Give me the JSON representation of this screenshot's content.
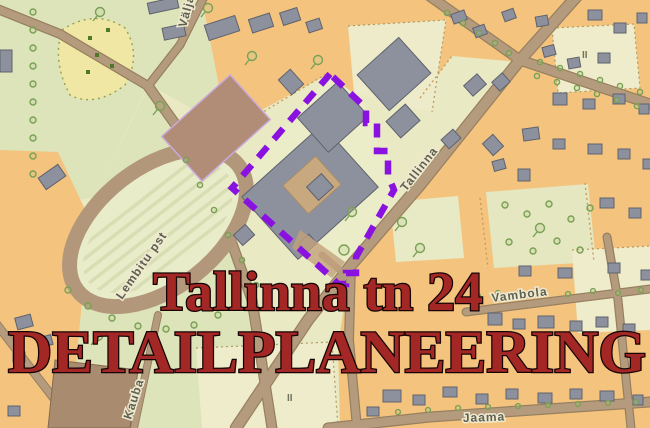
{
  "map": {
    "overlay": {
      "line1": "Tallinna tn 24",
      "line2": "DETAILPLANEERING",
      "text_color": "#a32725",
      "outline_color": "#150303"
    },
    "streets": [
      {
        "name": "Välja"
      },
      {
        "name": "Tallinna"
      },
      {
        "name": "Lembitu pst"
      },
      {
        "name": "Kauba"
      },
      {
        "name": "Vambola"
      },
      {
        "name": "Jaama"
      }
    ],
    "markers": [
      {
        "text": "II"
      },
      {
        "text": "II"
      }
    ],
    "boundary": {
      "color": "#8a12e0",
      "style": "dashed"
    },
    "colors": {
      "background": "#e9e9c4",
      "block_orange": "#f4c47f",
      "park_green": "#dde4ba",
      "field_yellow": "#efe7a3",
      "cream": "#eeecca",
      "road": "#b59b7d",
      "road_casing": "#97805f",
      "building": "#8d919d",
      "building_outline": "#5f626d",
      "track_brown": "#b2977b",
      "field_brown": "#b18c76",
      "tree_green": "#7aa056",
      "label_gray": "#5e6052"
    }
  }
}
